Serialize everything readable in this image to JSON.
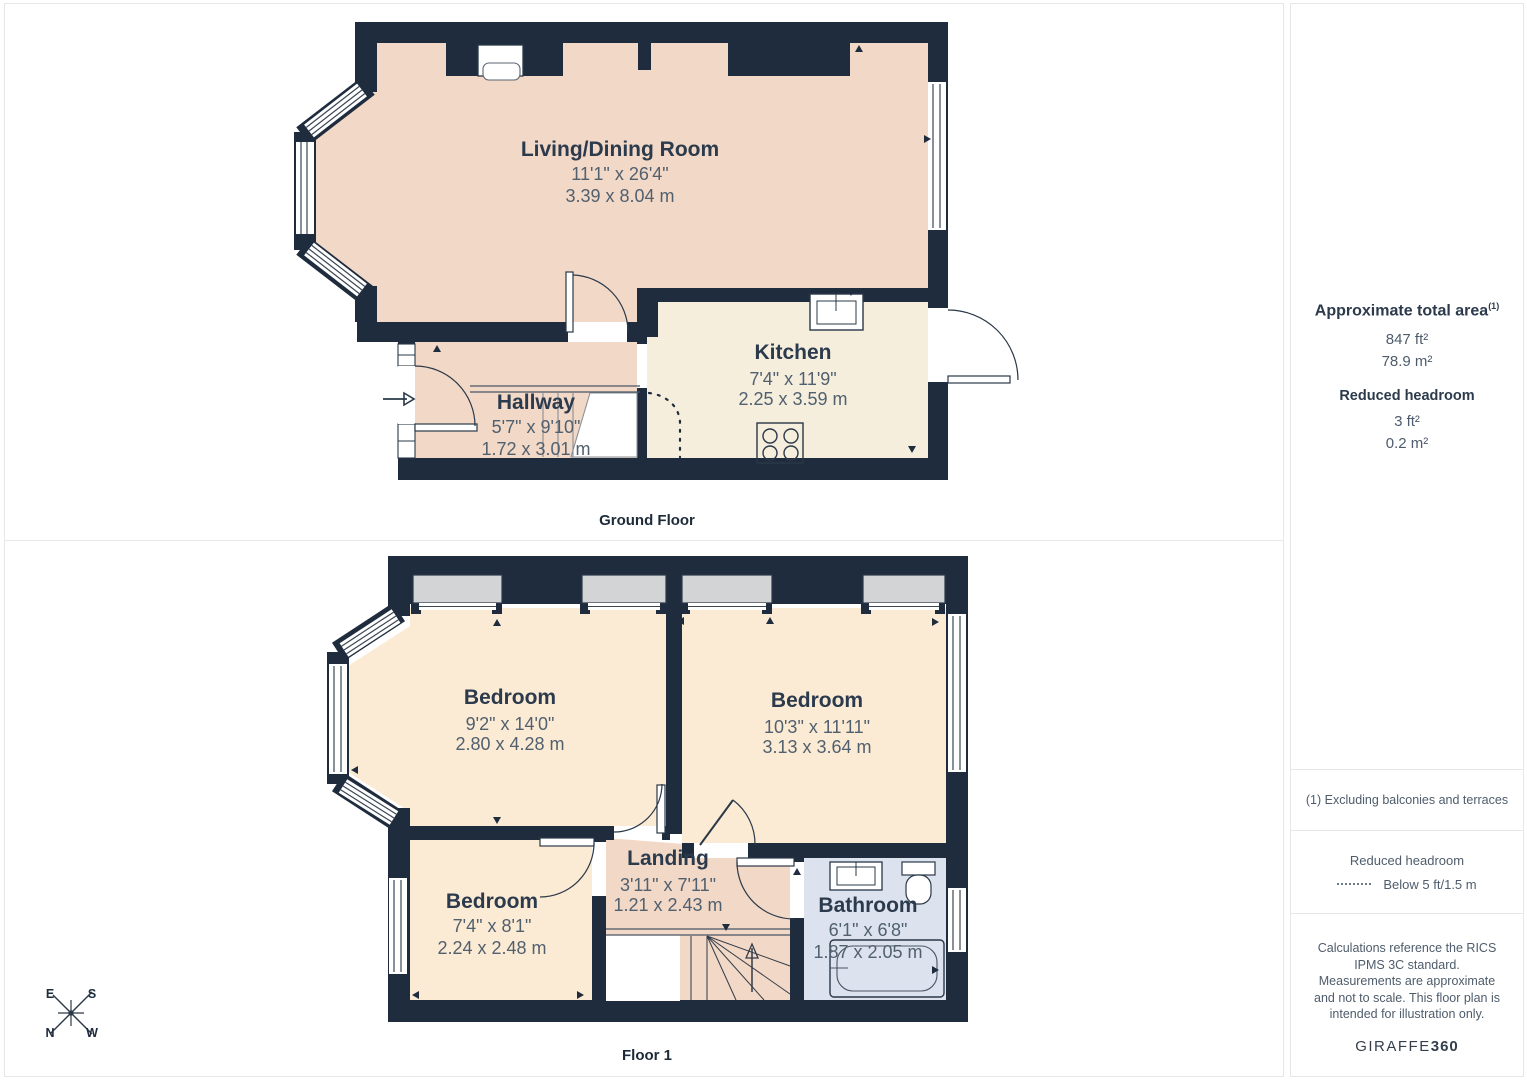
{
  "ground_floor": {
    "caption": "Ground Floor",
    "rooms": [
      {
        "name": "Living/Dining Room",
        "imperial": "11'1\" x 26'4\"",
        "metric": "3.39 x 8.04 m"
      },
      {
        "name": "Kitchen",
        "imperial": "7'4\" x 11'9\"",
        "metric": "2.25 x 3.59 m"
      },
      {
        "name": "Hallway",
        "imperial": "5'7\" x 9'10\"",
        "metric": "1.72 x 3.01 m"
      }
    ]
  },
  "floor_1": {
    "caption": "Floor 1",
    "rooms": [
      {
        "name": "Bedroom",
        "imperial": "9'2\" x 14'0\"",
        "metric": "2.80 x 4.28 m"
      },
      {
        "name": "Bedroom",
        "imperial": "10'3\" x 11'11\"",
        "metric": "3.13 x 3.64 m"
      },
      {
        "name": "Bedroom",
        "imperial": "7'4\" x 8'1\"",
        "metric": "2.24 x 2.48 m"
      },
      {
        "name": "Landing",
        "imperial": "3'11\" x 7'11\"",
        "metric": "1.21 x 2.43 m"
      },
      {
        "name": "Bathroom",
        "imperial": "6'1\" x 6'8\"",
        "metric": "1.87 x 2.05 m"
      }
    ]
  },
  "compass": {
    "top_left": "E",
    "top_right": "S",
    "bottom_left": "N",
    "bottom_right": "W"
  },
  "sidebar": {
    "total_area_title": "Approximate total area",
    "total_area_superscript": "(1)",
    "total_area_ft": "847 ft²",
    "total_area_m": "78.9 m²",
    "reduced_title": "Reduced headroom",
    "reduced_ft": "3 ft²",
    "reduced_m": "0.2 m²",
    "footnote": "(1) Excluding balconies and terraces",
    "legend_title": "Reduced headroom",
    "legend_value": "Below 5 ft/1.5 m",
    "disclaimer": "Calculations reference the RICS IPMS 3C standard. Measurements are approximate and not to scale. This floor plan is intended for illustration only.",
    "brand_name": "GIRAFFE",
    "brand_suffix": "360"
  },
  "colors": {
    "wall": "#1f2c3e",
    "room_warm": "#f2d8c6",
    "room_bedroom": "#fcebd4",
    "room_kitchen": "#f5eedd",
    "room_bath": "#dce2ee",
    "dormer": "#d2d4d6"
  }
}
